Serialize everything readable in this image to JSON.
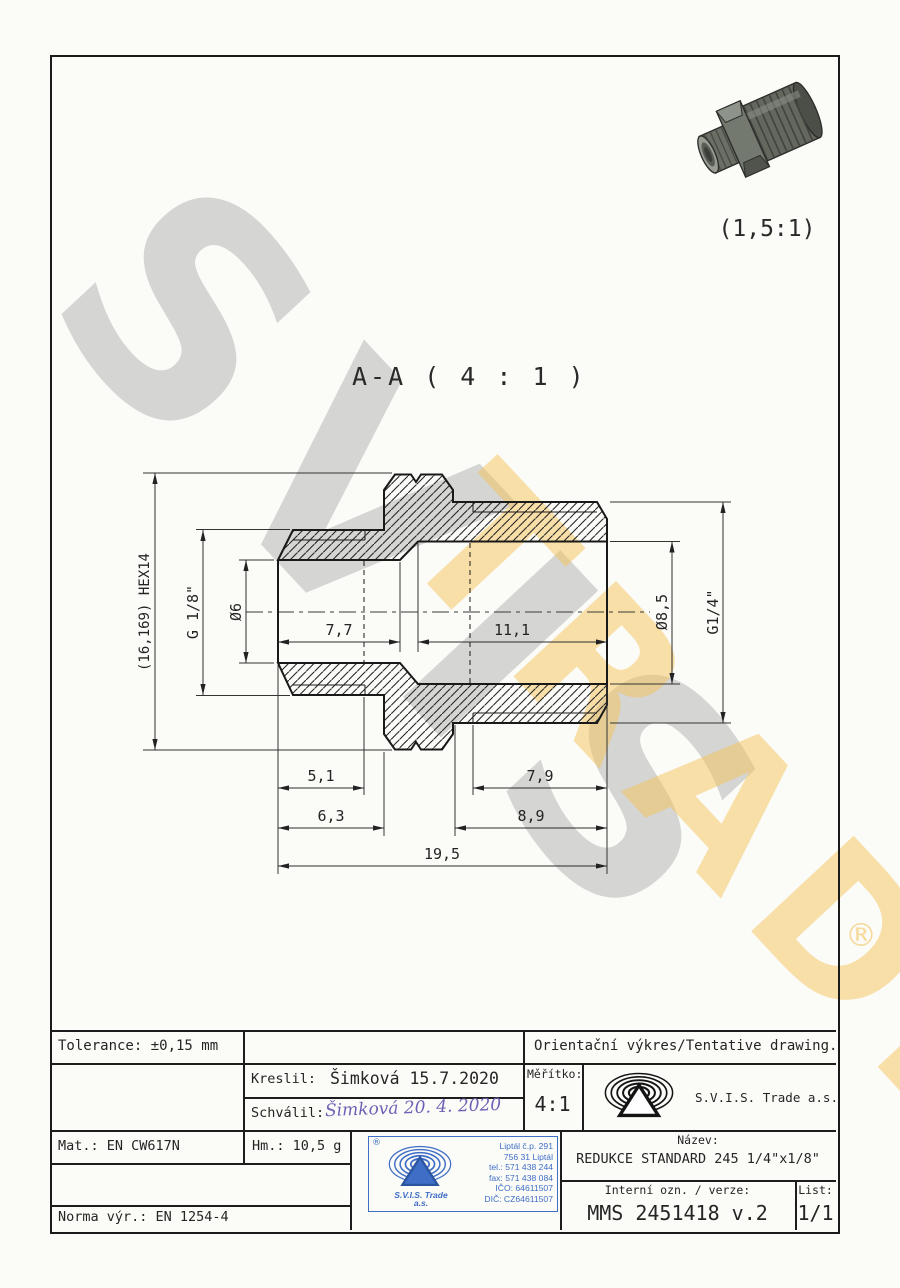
{
  "watermark": {
    "word1": "SVIS",
    "word2": "TRADE",
    "registered": "®",
    "grey_color": "#acacac",
    "yellow_color": "#f5c458"
  },
  "iso_view": {
    "scale_label": "(1,5:1)"
  },
  "section": {
    "title": "A-A ( 4 : 1 )"
  },
  "dimensions": {
    "hex_height": "(16,169) HEX14",
    "thread_left": "G 1/8\"",
    "bore_left": "Ø6",
    "bore_right": "Ø8,5",
    "thread_right": "G1/4\"",
    "len_bore_left": "7,7",
    "len_bore_right": "11,1",
    "len_thread_left": "5,1",
    "len_to_hex_left": "6,3",
    "len_thread_right": "7,9",
    "len_to_hex_right": "8,9",
    "len_total": "19,5"
  },
  "title_block": {
    "tolerance": "Tolerance: ±0,15 mm",
    "orientacni": "Orientační výkres/Tentative drawing.",
    "kreslil_label": "Kreslil:",
    "kreslil_value": "Šimková 15.7.2020",
    "schvalil_label": "Schválil:",
    "schvalil_value": "Šimková  20. 4. 2020",
    "meritko_label": "Měřítko:",
    "meritko_value": "4:1",
    "company": "S.V.I.S. Trade a.s.",
    "mat": "Mat.: EN CW617N",
    "hm": "Hm.: 10,5 g",
    "norma": "Norma výr.: EN 1254-4",
    "nazev_label": "Název:",
    "nazev_value": "REDUKCE STANDARD 245 1/4\"x1/8\"",
    "interni_label": "Interní ozn. / verze:",
    "interni_value": "MMS 2451418 v.2",
    "list_label": "List:",
    "list_value": "1/1"
  },
  "stamp": {
    "registered": "®",
    "company_line1": "S.V.I.S. Trade",
    "company_line2": "a.s.",
    "address_0": "Liptál č.p. 291",
    "address_1": "756 31 Liptál",
    "address_2": "tel.: 571 438 244",
    "address_3": "fax: 571 438 084",
    "address_4": "IČO: 64611507",
    "address_5": "DIČ: CZ64611507",
    "blue_color": "#3f6ec6"
  }
}
